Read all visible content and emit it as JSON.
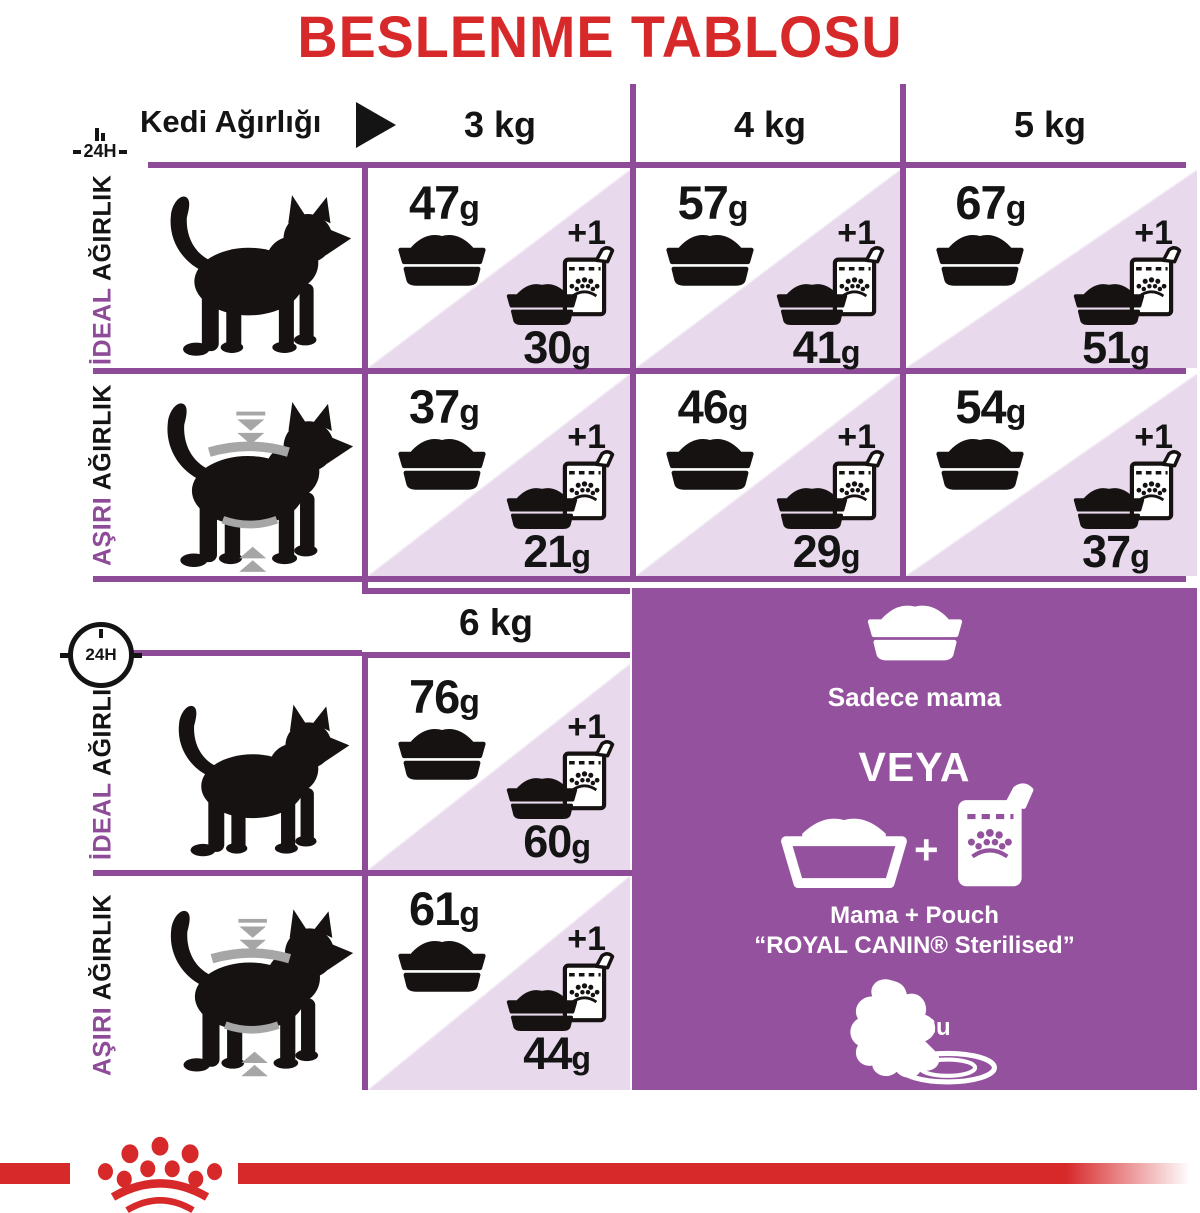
{
  "title": "BESLENME TABLOSU",
  "unit": "g",
  "plus_one": "+1",
  "clock": {
    "label": "24H"
  },
  "header": {
    "label": "Kedi Ağırlığı",
    "weights": [
      "3 kg",
      "4 kg",
      "5 kg"
    ],
    "weight_6kg": "6 kg"
  },
  "row_labels": {
    "ideal": {
      "accent": "İDEAL",
      "rest": " AĞIRLIK"
    },
    "over": {
      "accent": "AŞIRI",
      "rest": " AĞIRLIK"
    }
  },
  "cells": {
    "ideal": [
      {
        "dry": "47",
        "mix": "30"
      },
      {
        "dry": "57",
        "mix": "41"
      },
      {
        "dry": "67",
        "mix": "51"
      }
    ],
    "over": [
      {
        "dry": "37",
        "mix": "21"
      },
      {
        "dry": "46",
        "mix": "29"
      },
      {
        "dry": "54",
        "mix": "37"
      }
    ],
    "ideal_6": {
      "dry": "76",
      "mix": "60"
    },
    "over_6": {
      "dry": "61",
      "mix": "44"
    }
  },
  "promo": {
    "only_food": "Sadece mama",
    "or": "VEYA",
    "plus": "+",
    "mix_line1": "Mama + Pouch",
    "mix_line2": "“ROYAL CANIN® Sterilised”",
    "water": "Su"
  },
  "colors": {
    "red": "#d7282a",
    "grid_purple": "#8e4b98",
    "panel_purple": "#94519e",
    "lavender": "#e8d9ec"
  },
  "icons": {
    "bowl": "pet-food-bowl",
    "pouch": "food-pouch-crown-dots",
    "clock": "24h-clock",
    "splash": "water-splash-with-plate",
    "crown": "royal-canin-crown-logo",
    "arrow": "right-triangle"
  }
}
